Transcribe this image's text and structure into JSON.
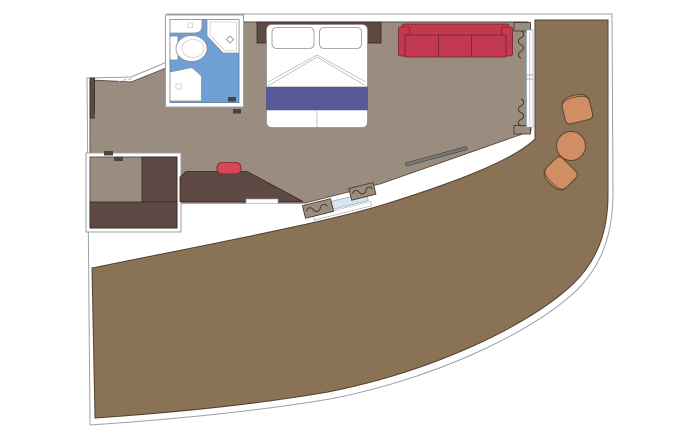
{
  "document_title": "Floor plan",
  "diagram": {
    "kind": "cabin-floor-plan",
    "palette": {
      "cabin_floor": "#9a8d7f",
      "balcony_floor": "#8a7256",
      "dark_wood": "#5f4944",
      "sofa_red": "#c23a4f",
      "chair_red": "#d9465a",
      "bathroom_blue": "#6f9fd5",
      "runner_blue": "#565a96",
      "patio_orange": "#d28e63",
      "glass_blue": "#d8e5ef",
      "white": "#ffffff"
    },
    "rooms": [
      {
        "name": "main-cabin"
      },
      {
        "name": "bathroom"
      },
      {
        "name": "wardrobe-alcove"
      },
      {
        "name": "wraparound-balcony"
      }
    ],
    "furniture": [
      {
        "name": "double-bed"
      },
      {
        "name": "headboard"
      },
      {
        "name": "sofa-three-seat"
      },
      {
        "name": "desk"
      },
      {
        "name": "desk-chair"
      },
      {
        "name": "wall-tv"
      },
      {
        "name": "wardrobe"
      },
      {
        "name": "toilet"
      },
      {
        "name": "corner-shower"
      },
      {
        "name": "vanity-sink"
      },
      {
        "name": "sink-counter"
      },
      {
        "name": "entry-door"
      },
      {
        "name": "balcony-sliding-door-side"
      },
      {
        "name": "balcony-sliding-door-aft"
      },
      {
        "name": "balcony-chair",
        "count": 2
      },
      {
        "name": "balcony-table",
        "count": 1
      }
    ]
  }
}
